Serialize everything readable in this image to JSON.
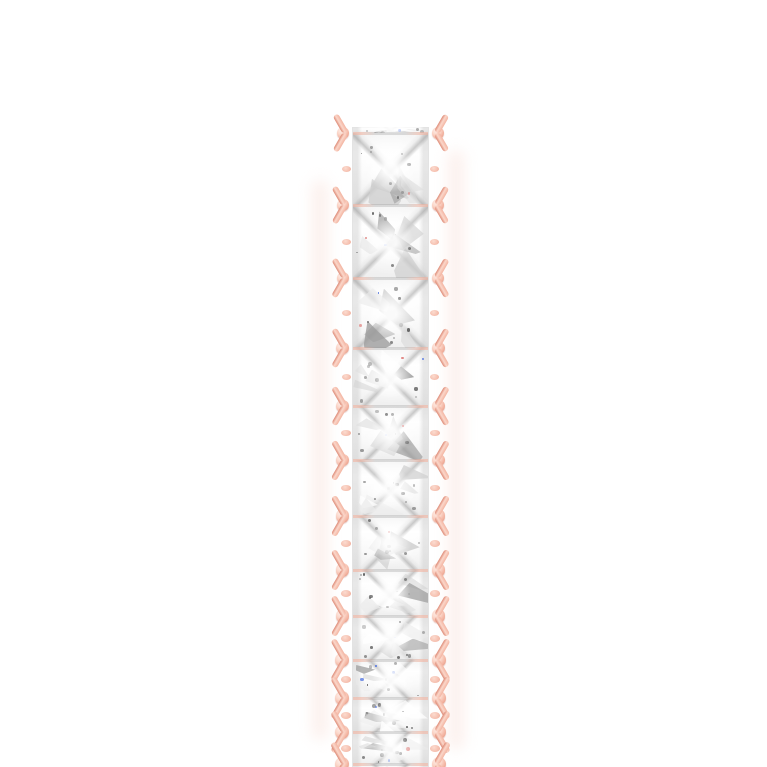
{
  "page": {
    "type": "product-photo",
    "background_color": "#ffffff"
  },
  "subject": {
    "item": "diamond eternity band ring",
    "view": "side profile close-up, band edge-on, cropped at bottom of frame",
    "metal_color_name": "rose gold",
    "stone_cut": "princess",
    "stone_rows": 1,
    "visible_stones": 13,
    "visible_prong_junctions": 13,
    "prong_style": "fishbone V-prongs with bead tips on both edges"
  },
  "palette": {
    "background": "#ffffff",
    "metal_base": "#f3b4a1",
    "metal_light": "#fbd7ca",
    "metal_highlight": "#feeee8",
    "metal_shadow": "#dd8a76",
    "metal_deep": "#c97a66",
    "diamond_white": "#ffffff",
    "facet_light": "#ebebeb",
    "facet_mid": "#cfcfcf",
    "facet_dark": "#9a9a9a",
    "fleck_dark": "#5f5f5f",
    "sparkle_blue": "#4a6fe0",
    "sparkle_red": "#e0827f",
    "haze_pink": "#f8ded6",
    "haze_blue": "#dff0f2"
  },
  "geometry": {
    "strip_left": 330,
    "strip_top": 127,
    "strip_width": 121,
    "strip_height": 640,
    "rail_width": 22,
    "column_width": 77,
    "first_junction_offset": 6,
    "cell_heights": [
      72,
      73,
      70,
      58,
      54,
      56,
      54,
      46,
      44,
      38,
      34,
      32,
      30
    ]
  }
}
